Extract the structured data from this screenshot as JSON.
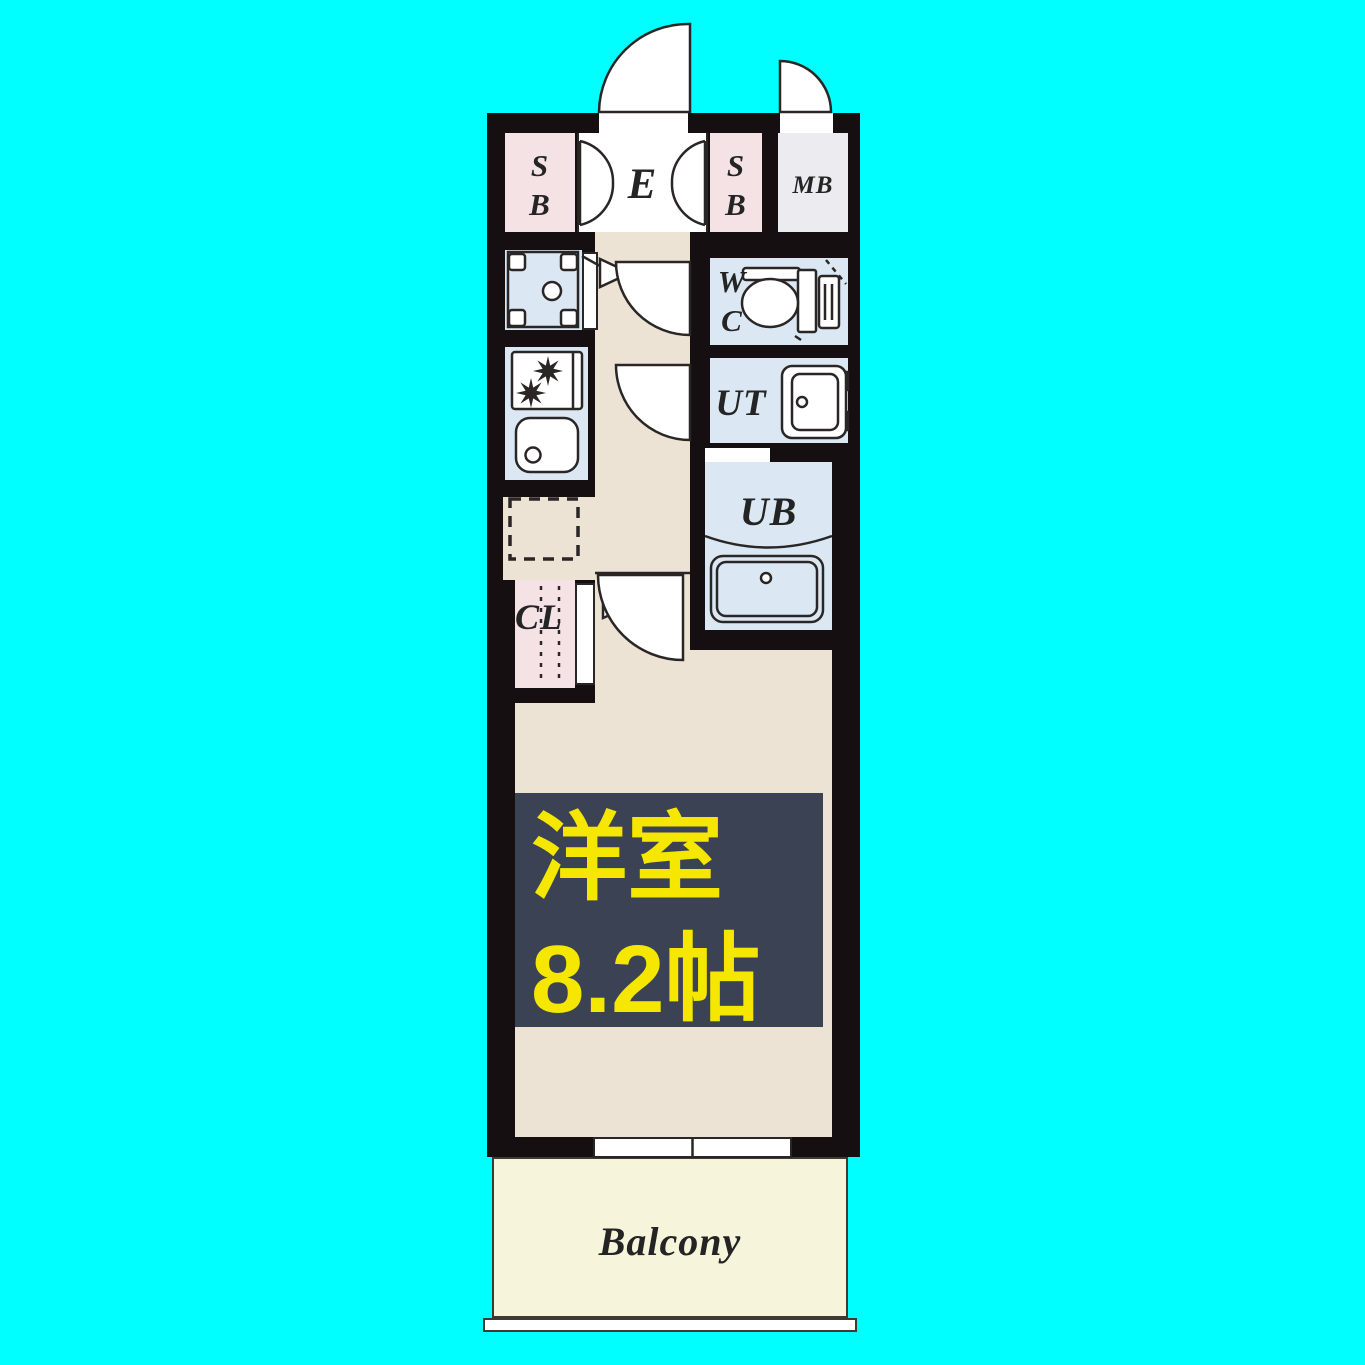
{
  "floorplan": {
    "rooms": {
      "shoe_box": {
        "line1": "S",
        "line2": "B"
      },
      "entrance": {
        "label": "E"
      },
      "meter_box": {
        "label": "MB"
      },
      "water_closet": {
        "line1": "W",
        "line2": "C"
      },
      "utility": {
        "label": "UT"
      },
      "unit_bath": {
        "label": "UB"
      },
      "closet": {
        "label": "CL"
      },
      "western_room": {
        "line1": "洋室",
        "line2": "8.2帖"
      },
      "balcony": {
        "label": "Balcony"
      }
    },
    "fixtures": [
      "entrance-door-swing",
      "meter-box-door-swing",
      "shoe-cabinet-double-doors",
      "washing-machine-pan",
      "gas-stove-two-burners",
      "kitchen-sink",
      "refrigerator-space-dashed",
      "toilet",
      "vanity-basin",
      "bathtub",
      "closet-hanger-rail",
      "wc-door-swing",
      "ut-door-swing",
      "room-door-swing",
      "sliding-window",
      "balcony-rail"
    ]
  },
  "colors": {
    "bg": "#00ffff",
    "wall": "#150f12",
    "floor": "#ece3d4",
    "pink": "#f5e2e4",
    "blue": "#dbe8f3",
    "mb": "#ecebf0",
    "cream": "#f7f4dc",
    "label_bg": "#3b4254",
    "label_yellow": "#f5e700",
    "line": "#2b2626",
    "ink": "#242424",
    "bline": "#3f3b33"
  }
}
